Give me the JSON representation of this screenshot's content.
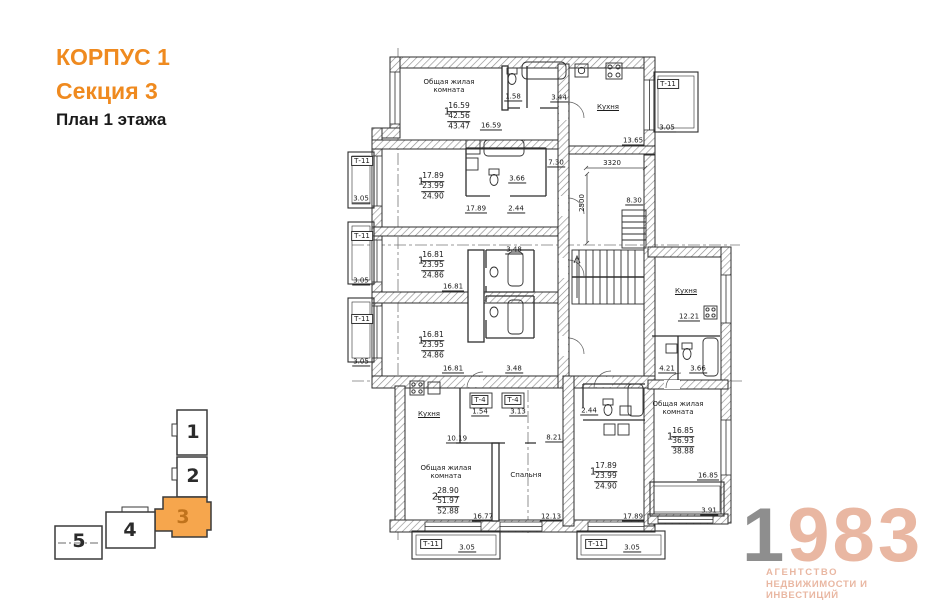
{
  "header": {
    "building": "КОРПУС 1",
    "section": "Секция 3",
    "floor": "План 1 этажа"
  },
  "colors": {
    "accent_orange": "#ef8a1f",
    "minimap_highlight": "#f6a64d",
    "minimap_number_active": "#c0731c",
    "minimap_number": "#2b2b2b",
    "logo_peach": "#e9b7a2",
    "logo_gray": "#8e8e8e"
  },
  "logo": {
    "digit_gray": "1",
    "digits_accent": "983",
    "caption_line1": "АГЕНТСТВО",
    "caption_line2": "НЕДВИЖИМОСТИ И ИНВЕСТИЦИЙ"
  },
  "minimap": {
    "sections": [
      {
        "label": "1",
        "x": 193,
        "y": 433,
        "highlighted": false
      },
      {
        "label": "2",
        "x": 193,
        "y": 477,
        "highlighted": false
      },
      {
        "label": "3",
        "x": 183,
        "y": 518,
        "highlighted": true
      },
      {
        "label": "4",
        "x": 130,
        "y": 531,
        "highlighted": false
      },
      {
        "label": "5",
        "x": 79,
        "y": 542,
        "highlighted": false
      }
    ]
  },
  "plan": {
    "labels": [
      {
        "text": "Общая жилая\nкомната",
        "x": 449,
        "y": 86,
        "cls": "room"
      },
      {
        "text": "Кухня",
        "x": 608,
        "y": 107,
        "cls": "room ru"
      },
      {
        "text": "Кухня",
        "x": 429,
        "y": 414,
        "cls": "room ru"
      },
      {
        "text": "Кухня",
        "x": 686,
        "y": 291,
        "cls": "room ru"
      },
      {
        "text": "Общая жилая\nкомната",
        "x": 446,
        "y": 472,
        "cls": "room"
      },
      {
        "text": "Спальня",
        "x": 526,
        "y": 475,
        "cls": "room"
      },
      {
        "text": "Общая жилая\nкомната",
        "x": 678,
        "y": 408,
        "cls": "room"
      },
      {
        "text": "16.59",
        "x": 459,
        "y": 107,
        "cls": "nu"
      },
      {
        "text": "42.56",
        "x": 459,
        "y": 117,
        "cls": "nu"
      },
      {
        "text": "43.47",
        "x": 459,
        "y": 127,
        "cls": "nn"
      },
      {
        "text": "1",
        "x": 447,
        "y": 112,
        "cls": "pf"
      },
      {
        "text": "17.89",
        "x": 433,
        "y": 177,
        "cls": "nu"
      },
      {
        "text": "23.99",
        "x": 433,
        "y": 187,
        "cls": "nu"
      },
      {
        "text": "24.90",
        "x": 433,
        "y": 197,
        "cls": "nn"
      },
      {
        "text": "1",
        "x": 421,
        "y": 182,
        "cls": "pf"
      },
      {
        "text": "16.81",
        "x": 433,
        "y": 256,
        "cls": "nu"
      },
      {
        "text": "23.95",
        "x": 433,
        "y": 266,
        "cls": "nu"
      },
      {
        "text": "24.86",
        "x": 433,
        "y": 276,
        "cls": "nn"
      },
      {
        "text": "1",
        "x": 421,
        "y": 261,
        "cls": "pf"
      },
      {
        "text": "16.81",
        "x": 433,
        "y": 336,
        "cls": "nu"
      },
      {
        "text": "23.95",
        "x": 433,
        "y": 346,
        "cls": "nu"
      },
      {
        "text": "24.86",
        "x": 433,
        "y": 356,
        "cls": "nn"
      },
      {
        "text": "1",
        "x": 421,
        "y": 341,
        "cls": "pf"
      },
      {
        "text": "28.90",
        "x": 448,
        "y": 492,
        "cls": "nu"
      },
      {
        "text": "51.97",
        "x": 448,
        "y": 502,
        "cls": "nu"
      },
      {
        "text": "52.88",
        "x": 448,
        "y": 512,
        "cls": "nn"
      },
      {
        "text": "2",
        "x": 435,
        "y": 497,
        "cls": "pf"
      },
      {
        "text": "17.89",
        "x": 606,
        "y": 467,
        "cls": "nu"
      },
      {
        "text": "23.99",
        "x": 606,
        "y": 477,
        "cls": "nu"
      },
      {
        "text": "24.90",
        "x": 606,
        "y": 487,
        "cls": "nn"
      },
      {
        "text": "1",
        "x": 593,
        "y": 472,
        "cls": "pf"
      },
      {
        "text": "16.85",
        "x": 683,
        "y": 432,
        "cls": "nu"
      },
      {
        "text": "36.93",
        "x": 683,
        "y": 442,
        "cls": "nu"
      },
      {
        "text": "38.88",
        "x": 683,
        "y": 452,
        "cls": "nn"
      },
      {
        "text": "1",
        "x": 670,
        "y": 437,
        "cls": "pf"
      },
      {
        "text": "1.58",
        "x": 513,
        "y": 97,
        "cls": "du"
      },
      {
        "text": "3.44",
        "x": 559,
        "y": 98,
        "cls": "du"
      },
      {
        "text": "13.65",
        "x": 633,
        "y": 141,
        "cls": "du"
      },
      {
        "text": "3.05",
        "x": 667,
        "y": 128,
        "cls": "du"
      },
      {
        "text": "16.59",
        "x": 491,
        "y": 126,
        "cls": "du"
      },
      {
        "text": "3.66",
        "x": 517,
        "y": 179,
        "cls": "du"
      },
      {
        "text": "17.89",
        "x": 476,
        "y": 209,
        "cls": "du"
      },
      {
        "text": "2.44",
        "x": 516,
        "y": 209,
        "cls": "du"
      },
      {
        "text": "7.30",
        "x": 556,
        "y": 163,
        "cls": "du"
      },
      {
        "text": "3320",
        "x": 612,
        "y": 163,
        "cls": "d"
      },
      {
        "text": "2500",
        "x": 582,
        "y": 203,
        "cls": "d vert"
      },
      {
        "text": "8.30",
        "x": 634,
        "y": 201,
        "cls": "du"
      },
      {
        "text": "3.05",
        "x": 361,
        "y": 199,
        "cls": "du"
      },
      {
        "text": "3.05",
        "x": 361,
        "y": 281,
        "cls": "du"
      },
      {
        "text": "3.05",
        "x": 361,
        "y": 362,
        "cls": "du"
      },
      {
        "text": "3.48",
        "x": 514,
        "y": 250,
        "cls": "du"
      },
      {
        "text": "16.81",
        "x": 453,
        "y": 287,
        "cls": "du"
      },
      {
        "text": "16.81",
        "x": 453,
        "y": 369,
        "cls": "du"
      },
      {
        "text": "3.48",
        "x": 514,
        "y": 369,
        "cls": "du"
      },
      {
        "text": "1.54",
        "x": 480,
        "y": 412,
        "cls": "du"
      },
      {
        "text": "3.13",
        "x": 518,
        "y": 412,
        "cls": "du"
      },
      {
        "text": "10.19",
        "x": 457,
        "y": 439,
        "cls": "du"
      },
      {
        "text": "16.77",
        "x": 483,
        "y": 517,
        "cls": "du"
      },
      {
        "text": "8.21",
        "x": 554,
        "y": 438,
        "cls": "du"
      },
      {
        "text": "12.13",
        "x": 551,
        "y": 517,
        "cls": "du"
      },
      {
        "text": "2.44",
        "x": 589,
        "y": 411,
        "cls": "du"
      },
      {
        "text": "17.89",
        "x": 633,
        "y": 517,
        "cls": "du"
      },
      {
        "text": "12.21",
        "x": 689,
        "y": 317,
        "cls": "du"
      },
      {
        "text": "4.21",
        "x": 667,
        "y": 369,
        "cls": "du"
      },
      {
        "text": "3.66",
        "x": 698,
        "y": 369,
        "cls": "du"
      },
      {
        "text": "16.85",
        "x": 708,
        "y": 476,
        "cls": "du"
      },
      {
        "text": "3.91",
        "x": 709,
        "y": 511,
        "cls": "du"
      },
      {
        "text": "3.05",
        "x": 467,
        "y": 548,
        "cls": "du"
      },
      {
        "text": "3.05",
        "x": 632,
        "y": 548,
        "cls": "du"
      },
      {
        "text": "Т-11",
        "x": 362,
        "y": 161,
        "cls": "boxed"
      },
      {
        "text": "Т-11",
        "x": 362,
        "y": 236,
        "cls": "boxed"
      },
      {
        "text": "Т-11",
        "x": 362,
        "y": 319,
        "cls": "boxed"
      },
      {
        "text": "Т-11",
        "x": 668,
        "y": 84,
        "cls": "boxed"
      },
      {
        "text": "Т-11",
        "x": 431,
        "y": 544,
        "cls": "boxed"
      },
      {
        "text": "Т-11",
        "x": 596,
        "y": 544,
        "cls": "boxed"
      },
      {
        "text": "Т-4",
        "x": 480,
        "y": 400,
        "cls": "boxed"
      },
      {
        "text": "Т-4",
        "x": 513,
        "y": 400,
        "cls": "boxed"
      }
    ]
  }
}
